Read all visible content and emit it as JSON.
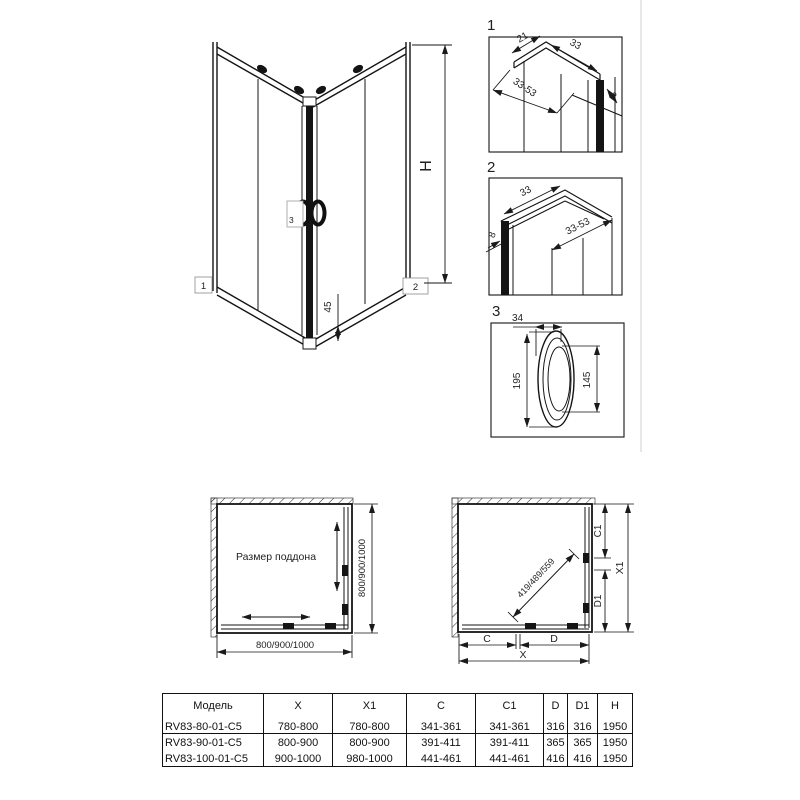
{
  "iso_view": {
    "height_label": "H",
    "rail_height": "45",
    "callout_1": "1",
    "callout_2": "2",
    "callout_3": "3"
  },
  "details": {
    "num_1": "1",
    "num_2": "2",
    "num_3": "3",
    "d1": {
      "w21": "21",
      "w33": "33",
      "range": "33-53",
      "t8": "8"
    },
    "d2": {
      "w33": "33",
      "range": "33-53",
      "t8": "8"
    },
    "d3": {
      "w34": "34",
      "h195": "195",
      "h145": "145"
    }
  },
  "plan_left": {
    "label": "Размер поддона",
    "width_dim": "800/900/1000",
    "depth_dim": "800/900/1000"
  },
  "plan_right": {
    "diagonal_dim": "419/489/559",
    "c": "C",
    "d": "D",
    "x": "X",
    "c1": "C1",
    "d1": "D1",
    "x1": "X1"
  },
  "table": {
    "headers": [
      "Модель",
      "X",
      "X1",
      "C",
      "C1",
      "D",
      "D1",
      "H"
    ],
    "rows": [
      [
        "RV83-80-01-C5",
        "780-800",
        "780-800",
        "341-361",
        "341-361",
        "316",
        "316",
        "1950"
      ],
      [
        "RV83-90-01-C5",
        "800-900",
        "800-900",
        "391-411",
        "391-411",
        "365",
        "365",
        "1950"
      ],
      [
        "RV83-100-01-C5",
        "900-1000",
        "980-1000",
        "441-461",
        "441-461",
        "416",
        "416",
        "1950"
      ]
    ]
  }
}
